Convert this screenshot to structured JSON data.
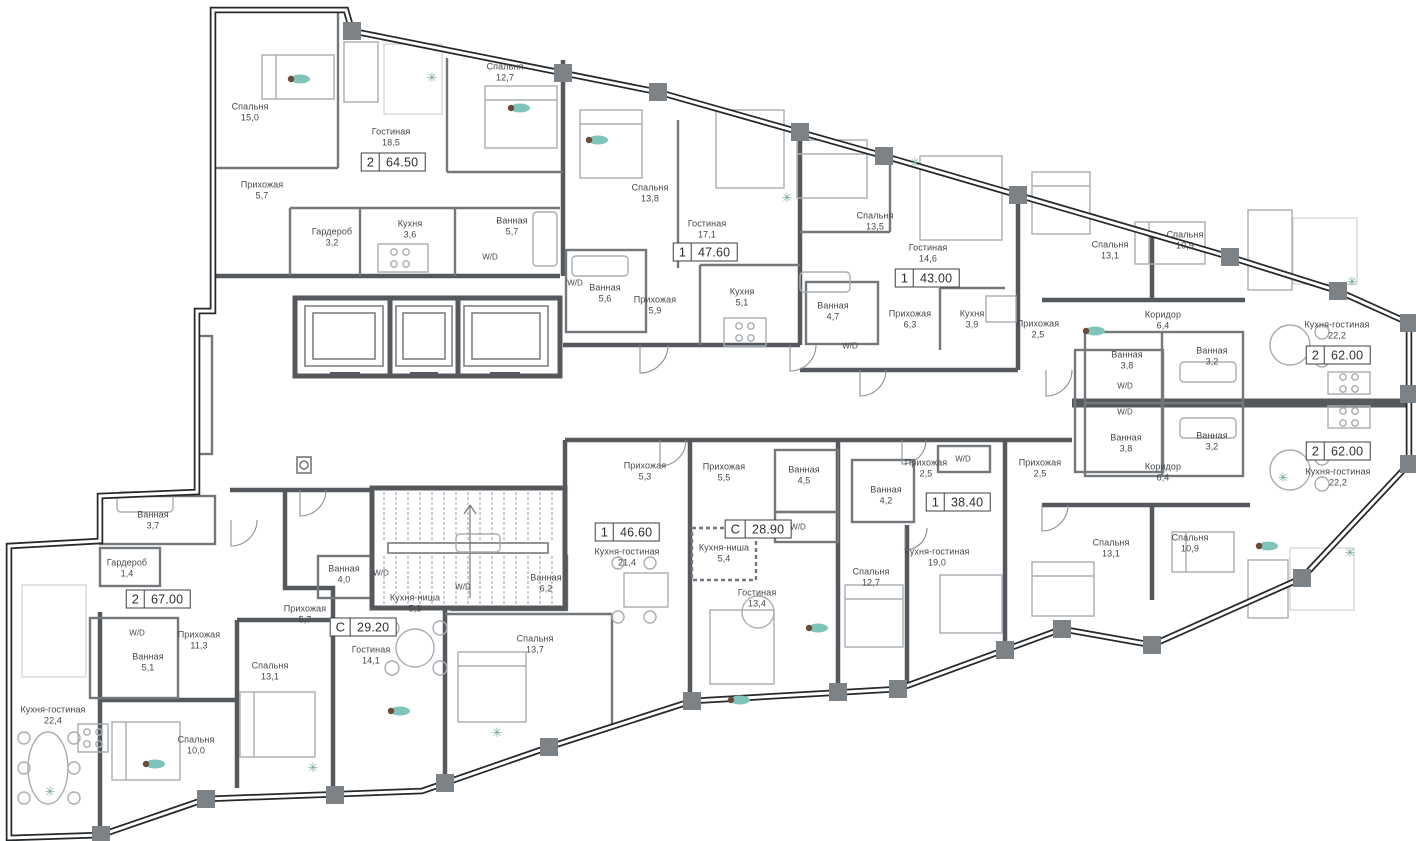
{
  "plan_type": "residential-floor-plan",
  "wd_text": "W/D",
  "colors": {
    "wall": "#55595d",
    "partition": "#74787c",
    "facade": "#26292c",
    "pier": "#7d8286",
    "furniture": "#a8adb1",
    "label": "#43474b",
    "accent_teal": "#7fc4bb",
    "plant_green": "#74a796"
  },
  "apartments": [
    {
      "id": "apt-2-6450",
      "type": "2",
      "area": "64.50",
      "badge_x": 393,
      "badge_y": 162,
      "rooms": [
        {
          "name": "Спальня",
          "area": "15,0",
          "x": 250,
          "y": 112
        },
        {
          "name": "Спальня",
          "area": "12,7",
          "x": 505,
          "y": 72
        },
        {
          "name": "Гостиная",
          "area": "18,5",
          "x": 391,
          "y": 137
        },
        {
          "name": "Прихожая",
          "area": "5,7",
          "x": 262,
          "y": 190
        },
        {
          "name": "Гардероб",
          "area": "3,2",
          "x": 332,
          "y": 237
        },
        {
          "name": "Кухня",
          "area": "3,6",
          "x": 410,
          "y": 229
        },
        {
          "name": "Ванная",
          "area": "5,7",
          "x": 512,
          "y": 226
        }
      ]
    },
    {
      "id": "apt-1-4760",
      "type": "1",
      "area": "47.60",
      "badge_x": 705,
      "badge_y": 252,
      "rooms": [
        {
          "name": "Спальня",
          "area": "13,8",
          "x": 650,
          "y": 193
        },
        {
          "name": "Гостиная",
          "area": "17,1",
          "x": 707,
          "y": 229
        },
        {
          "name": "Ванная",
          "area": "5,6",
          "x": 605,
          "y": 293
        },
        {
          "name": "Прихожая",
          "area": "5,9",
          "x": 655,
          "y": 305
        },
        {
          "name": "Кухня",
          "area": "5,1",
          "x": 742,
          "y": 297
        }
      ]
    },
    {
      "id": "apt-1-4300",
      "type": "1",
      "area": "43.00",
      "badge_x": 927,
      "badge_y": 278,
      "rooms": [
        {
          "name": "Спальня",
          "area": "13,5",
          "x": 875,
          "y": 221
        },
        {
          "name": "Гостиная",
          "area": "14,6",
          "x": 928,
          "y": 253
        },
        {
          "name": "Ванная",
          "area": "4,7",
          "x": 833,
          "y": 311
        },
        {
          "name": "Прихожая",
          "area": "6,3",
          "x": 910,
          "y": 319
        },
        {
          "name": "Кухня",
          "area": "3,9",
          "x": 972,
          "y": 319
        }
      ]
    },
    {
      "id": "apt-2-6200-top",
      "type": "2",
      "area": "62.00",
      "badge_x": 1338,
      "badge_y": 355,
      "rooms": [
        {
          "name": "Спальня",
          "area": "13,1",
          "x": 1110,
          "y": 250
        },
        {
          "name": "Спальня",
          "area": "10,9",
          "x": 1185,
          "y": 240
        },
        {
          "name": "Коридор",
          "area": "6,4",
          "x": 1163,
          "y": 320
        },
        {
          "name": "Прихожая",
          "area": "2,5",
          "x": 1038,
          "y": 329
        },
        {
          "name": "Ванная",
          "area": "3,8",
          "x": 1127,
          "y": 360
        },
        {
          "name": "Ванная",
          "area": "3,2",
          "x": 1212,
          "y": 356
        },
        {
          "name": "Кухня-гостиная",
          "area": "22,2",
          "x": 1337,
          "y": 330
        }
      ]
    },
    {
      "id": "apt-2-6200-bottom",
      "type": "2",
      "area": "62.00",
      "badge_x": 1338,
      "badge_y": 451,
      "rooms": [
        {
          "name": "Кухня-гостиная",
          "area": "22,2",
          "x": 1338,
          "y": 477
        },
        {
          "name": "Ванная",
          "area": "3,8",
          "x": 1126,
          "y": 443
        },
        {
          "name": "Ванная",
          "area": "3,2",
          "x": 1212,
          "y": 441
        },
        {
          "name": "Коридор",
          "area": "6,4",
          "x": 1163,
          "y": 472
        },
        {
          "name": "Прихожая",
          "area": "2,5",
          "x": 1040,
          "y": 468
        },
        {
          "name": "Спальня",
          "area": "13,1",
          "x": 1111,
          "y": 548
        },
        {
          "name": "Спальня",
          "area": "10,9",
          "x": 1190,
          "y": 543
        }
      ]
    },
    {
      "id": "apt-1-3840",
      "type": "1",
      "area": "38.40",
      "badge_x": 958,
      "badge_y": 502,
      "rooms": [
        {
          "name": "Прихожая",
          "area": "2,5",
          "x": 926,
          "y": 468
        },
        {
          "name": "Ванная",
          "area": "4,2",
          "x": 886,
          "y": 495
        },
        {
          "name": "Кухня-гостиная",
          "area": "19,0",
          "x": 937,
          "y": 557
        },
        {
          "name": "Спальня",
          "area": "12,7",
          "x": 871,
          "y": 577
        }
      ]
    },
    {
      "id": "apt-s-2890",
      "type": "С",
      "area": "28.90",
      "badge_x": 758,
      "badge_y": 529,
      "rooms": [
        {
          "name": "Прихожая",
          "area": "5,5",
          "x": 724,
          "y": 472
        },
        {
          "name": "Ванная",
          "area": "4,5",
          "x": 804,
          "y": 475
        },
        {
          "name": "Кухня-ниша",
          "area": "5,4",
          "x": 724,
          "y": 553
        },
        {
          "name": "Гостиная",
          "area": "13,4",
          "x": 757,
          "y": 598
        }
      ]
    },
    {
      "id": "apt-1-4660",
      "type": "1",
      "area": "46.60",
      "badge_x": 627,
      "badge_y": 532,
      "rooms": [
        {
          "name": "Прихожая",
          "area": "5,3",
          "x": 645,
          "y": 471
        },
        {
          "name": "Кухня-гостиная",
          "area": "21,4",
          "x": 627,
          "y": 557
        },
        {
          "name": "Ванная",
          "area": "6,2",
          "x": 546,
          "y": 583
        },
        {
          "name": "Спальня",
          "area": "13,7",
          "x": 535,
          "y": 644
        }
      ]
    },
    {
      "id": "apt-s-2920",
      "type": "С",
      "area": "29.20",
      "badge_x": 363,
      "badge_y": 627,
      "rooms": [
        {
          "name": "Ванная",
          "area": "4,0",
          "x": 344,
          "y": 574
        },
        {
          "name": "Прихожая",
          "area": "5,7",
          "x": 305,
          "y": 614
        },
        {
          "name": "Кухня-ниша",
          "area": "5,3",
          "x": 415,
          "y": 603
        },
        {
          "name": "Гостиная",
          "area": "14,1",
          "x": 371,
          "y": 655
        }
      ]
    },
    {
      "id": "apt-2-6700",
      "type": "2",
      "area": "67.00",
      "badge_x": 158,
      "badge_y": 599,
      "rooms": [
        {
          "name": "Ванная",
          "area": "3,7",
          "x": 153,
          "y": 520
        },
        {
          "name": "Гардероб",
          "area": "1,4",
          "x": 127,
          "y": 568
        },
        {
          "name": "Прихожая",
          "area": "11,3",
          "x": 199,
          "y": 640
        },
        {
          "name": "Ванная",
          "area": "5,1",
          "x": 148,
          "y": 662
        },
        {
          "name": "Кухня-гостиная",
          "area": "22,4",
          "x": 53,
          "y": 715
        },
        {
          "name": "Спальня",
          "area": "13,1",
          "x": 270,
          "y": 671
        },
        {
          "name": "Спальня",
          "area": "10,0",
          "x": 196,
          "y": 745
        }
      ]
    }
  ],
  "wd_labels": [
    {
      "x": 490,
      "y": 257
    },
    {
      "x": 575,
      "y": 283
    },
    {
      "x": 850,
      "y": 346
    },
    {
      "x": 963,
      "y": 459
    },
    {
      "x": 798,
      "y": 527
    },
    {
      "x": 463,
      "y": 587
    },
    {
      "x": 381,
      "y": 573
    },
    {
      "x": 137,
      "y": 633
    },
    {
      "x": 1125,
      "y": 386
    },
    {
      "x": 1125,
      "y": 412
    }
  ],
  "decor": {
    "plants": [
      {
        "x": 432,
        "y": 78
      },
      {
        "x": 787,
        "y": 198
      },
      {
        "x": 915,
        "y": 163
      },
      {
        "x": 1352,
        "y": 282
      },
      {
        "x": 1350,
        "y": 553
      },
      {
        "x": 1283,
        "y": 478
      },
      {
        "x": 313,
        "y": 768
      },
      {
        "x": 497,
        "y": 733
      },
      {
        "x": 50,
        "y": 792
      }
    ],
    "people": [
      {
        "x": 300,
        "y": 79
      },
      {
        "x": 520,
        "y": 108
      },
      {
        "x": 598,
        "y": 140
      },
      {
        "x": 1095,
        "y": 331
      },
      {
        "x": 818,
        "y": 628
      },
      {
        "x": 740,
        "y": 700
      },
      {
        "x": 1268,
        "y": 546
      },
      {
        "x": 155,
        "y": 764
      },
      {
        "x": 400,
        "y": 711
      }
    ]
  }
}
